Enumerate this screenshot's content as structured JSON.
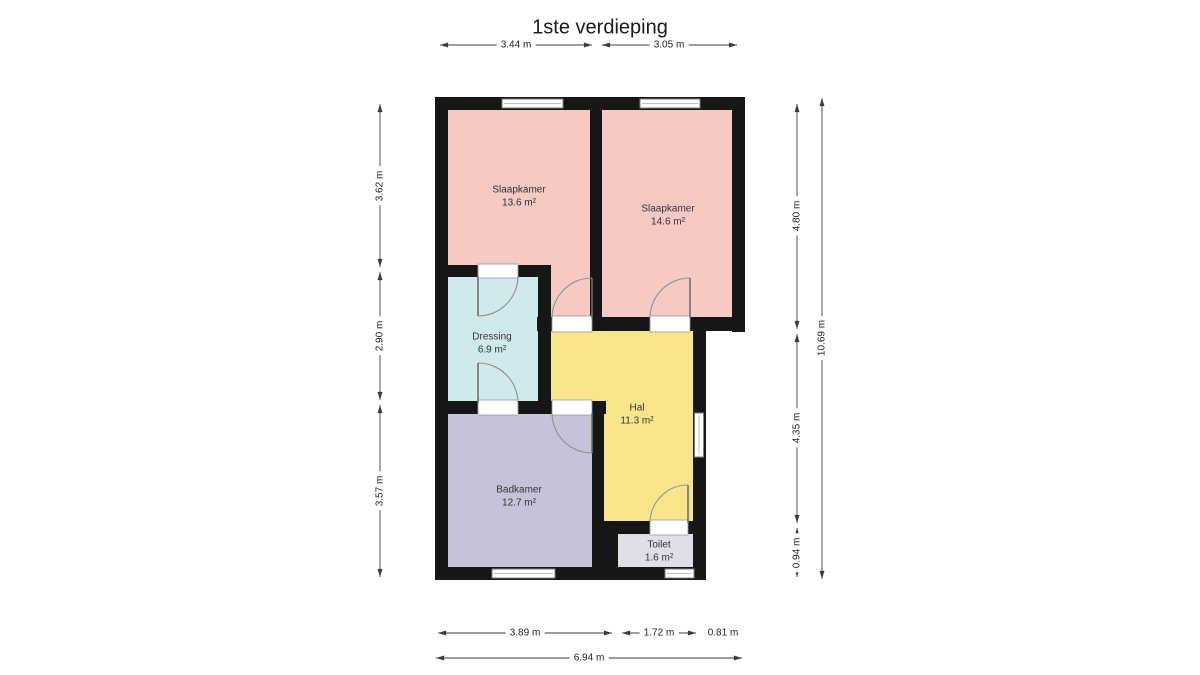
{
  "title": "1ste verdieping",
  "rooms": [
    {
      "name": "Slaapkamer",
      "area": "13.6 m²",
      "color": "#f7c9c4"
    },
    {
      "name": "Slaapkamer",
      "area": "14.6 m²",
      "color": "#f7c9c4"
    },
    {
      "name": "Dressing",
      "area": "6.9 m²",
      "color": "#cfe9ed"
    },
    {
      "name": "Hal",
      "area": "11.3 m²",
      "color": "#fae58c"
    },
    {
      "name": "Badkamer",
      "area": "12.7 m²",
      "color": "#c6c3d9"
    },
    {
      "name": "Toilet",
      "area": "1.6 m²",
      "color": "#dfdfe8"
    }
  ],
  "dimensions": {
    "top": [
      "3.44 m",
      "3.05 m"
    ],
    "left": [
      "3.62 m",
      "2.90 m",
      "3.57 m"
    ],
    "right_inner": [
      "4.80 m",
      "4.35 m",
      "0.94 m"
    ],
    "right_outer": "10.69 m",
    "bottom_row1": [
      "3.89 m",
      "1.72 m",
      "0.81 m"
    ],
    "bottom_total": "6.94 m"
  },
  "colors": {
    "wall": "#161616",
    "window_fill": "#ffffff",
    "window_stroke": "#7d7d7d",
    "door_arc": "#8f8f8f",
    "dimension_line": "#3c3c3c",
    "label_text": "#333333",
    "background": "#ffffff"
  }
}
